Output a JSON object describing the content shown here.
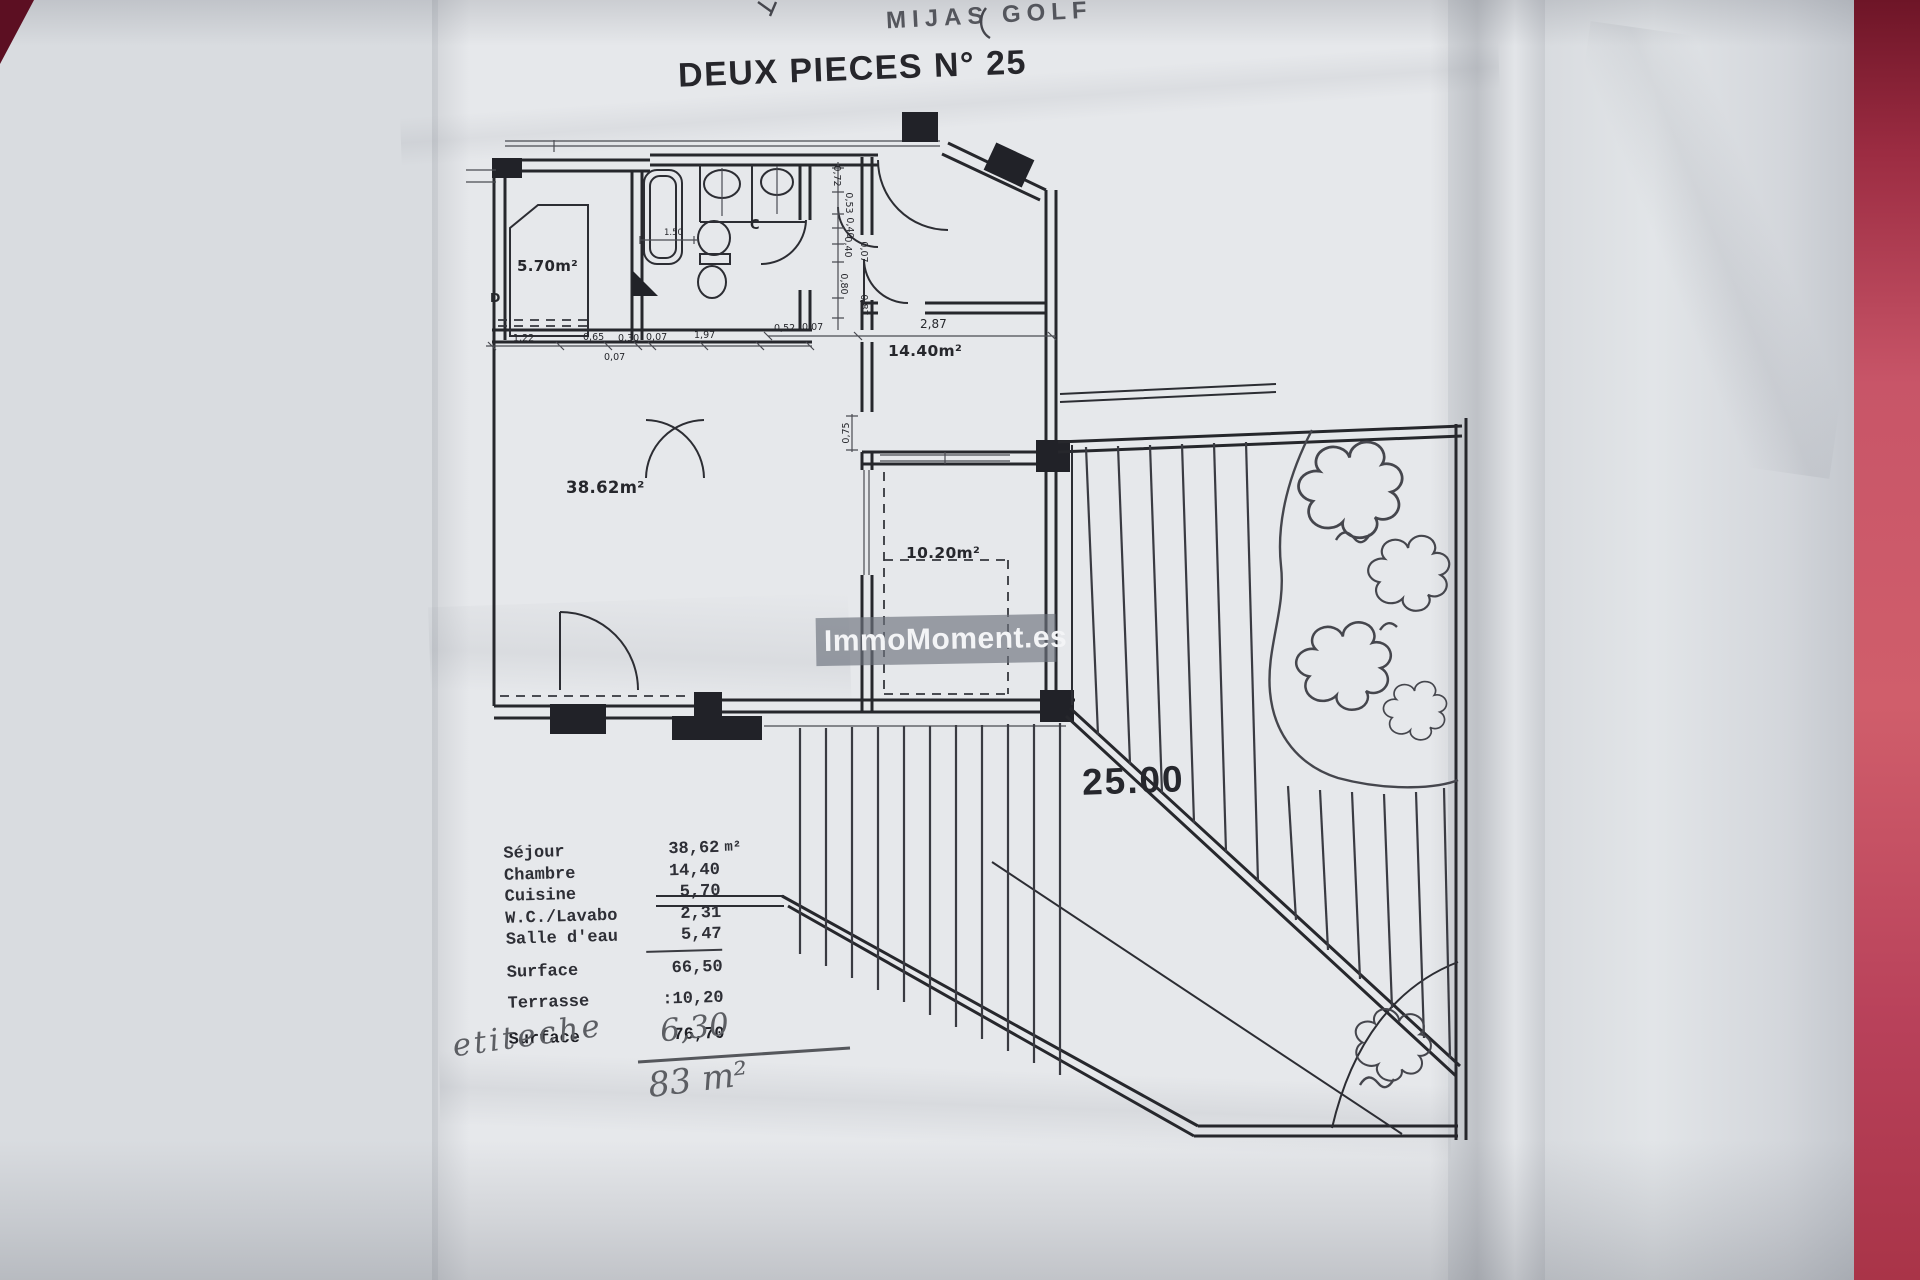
{
  "palette": {
    "paper": "#e6e8eb",
    "ink": "#26272c",
    "desk_red": "#c85568",
    "pencil": "#5c5e63",
    "watermark_band": "#6d737e"
  },
  "top_note": {
    "handwriting": "MIJAS GOLF"
  },
  "title": "DEUX PIECES N° 25",
  "watermark": "ImmoMoment.es",
  "plan": {
    "labels": {
      "cuisine": "5.70m²",
      "sejour": "38.62m²",
      "chambre": "14.40m²",
      "terrasse": "10.20m²",
      "letter_c": "C",
      "letter_d": "D",
      "terrace_mark": "25.00"
    },
    "dims": {
      "bath_toilet": "1.50",
      "row": [
        "1,22",
        "0,65",
        "0,30",
        "0,07",
        "1,97"
      ],
      "row_below": "0,07",
      "hall": [
        "0,52",
        "0,07"
      ],
      "chambre_width": "2,87",
      "entry": [
        "0,72",
        "0,53",
        "0,40",
        "0,40",
        "0,07",
        "0,80",
        "0,87"
      ],
      "sejour_door": "0,75"
    }
  },
  "table": {
    "rows": [
      {
        "label": "Séjour",
        "value": "38,62",
        "unit": "m²"
      },
      {
        "label": "Chambre",
        "value": "14,40",
        "unit": ""
      },
      {
        "label": "Cuisine",
        "value": "5,70",
        "unit": ""
      },
      {
        "label": "W.C./Lavabo",
        "value": "2,31",
        "unit": ""
      },
      {
        "label": "Salle d'eau",
        "value": "5,47",
        "unit": ""
      }
    ],
    "surface1": {
      "label": "Surface",
      "value": "66,50"
    },
    "terrasse": {
      "label": "Terrasse",
      "value": ":10,20"
    },
    "surface2": {
      "label": "Surface",
      "value": "76,70"
    },
    "handwriting": {
      "word": "etiteche",
      "value": "6,30",
      "total": "83 m²"
    }
  }
}
